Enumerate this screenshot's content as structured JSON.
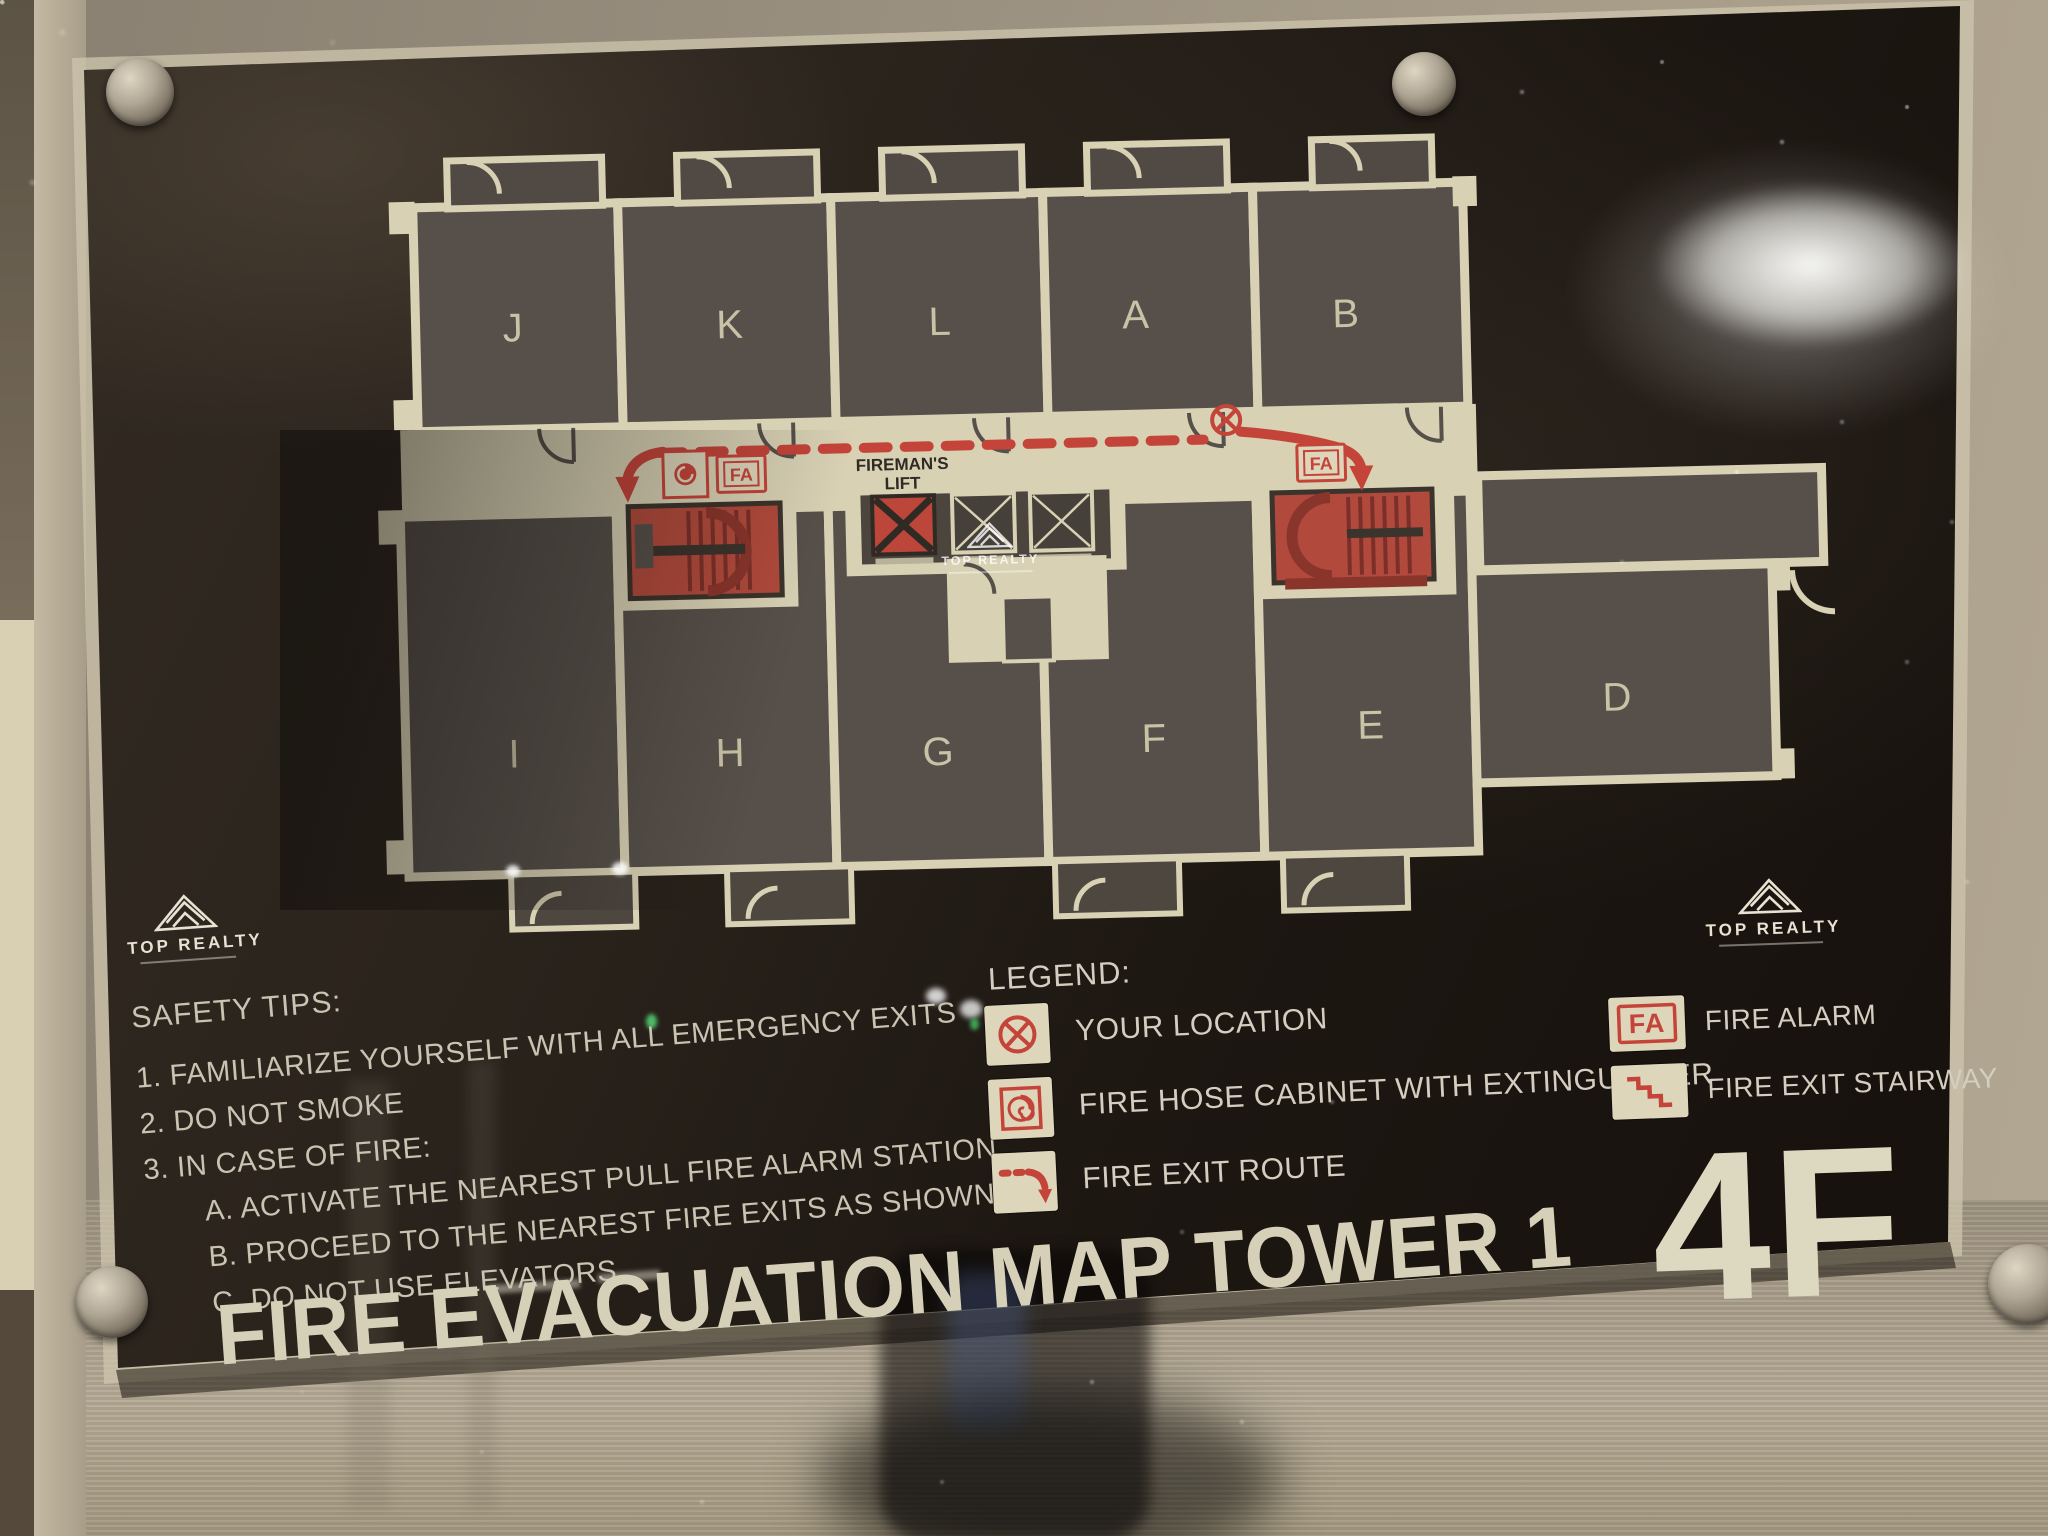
{
  "brand": {
    "name": "TOP REALTY"
  },
  "plan": {
    "rooms_top": [
      "J",
      "K",
      "L",
      "A",
      "B"
    ],
    "rooms_bottom": [
      "I",
      "H",
      "G",
      "F",
      "E",
      "D"
    ],
    "fireman_lift_line1": "FIREMAN'S",
    "fireman_lift_line2": "LIFT",
    "fire_alarm_abbr": "FA"
  },
  "legend": {
    "heading": "LEGEND:",
    "items": [
      {
        "icon": "your-location-icon",
        "label": "YOUR LOCATION"
      },
      {
        "icon": "fire-hose-icon",
        "label": "FIRE HOSE CABINET WITH EXTINGUISHER"
      },
      {
        "icon": "fire-exit-route-icon",
        "label": "FIRE EXIT ROUTE"
      },
      {
        "icon": "fire-alarm-icon",
        "icon_text": "FA",
        "label": "FIRE ALARM"
      },
      {
        "icon": "fire-exit-stairway-icon",
        "label": "FIRE EXIT STAIRWAY"
      }
    ]
  },
  "safety_tips": {
    "heading": "SAFETY TIPS:",
    "lines": [
      "1. FAMILIARIZE YOURSELF WITH ALL EMERGENCY EXITS",
      "2. DO NOT SMOKE",
      "3. IN CASE OF FIRE:",
      "A. ACTIVATE THE NEAREST PULL FIRE ALARM STATION",
      "B. PROCEED TO THE NEAREST FIRE EXITS AS SHOWN",
      "C. DO NOT USE ELEVATORS"
    ]
  },
  "footer": {
    "title": "FIRE EVACUATION MAP TOWER 1",
    "floor": "4F"
  },
  "colors": {
    "accent_red": "#c5443a",
    "plan_cream": "#d8d1b4",
    "sign_black": "#1d1712",
    "metal": "#a89d89"
  }
}
